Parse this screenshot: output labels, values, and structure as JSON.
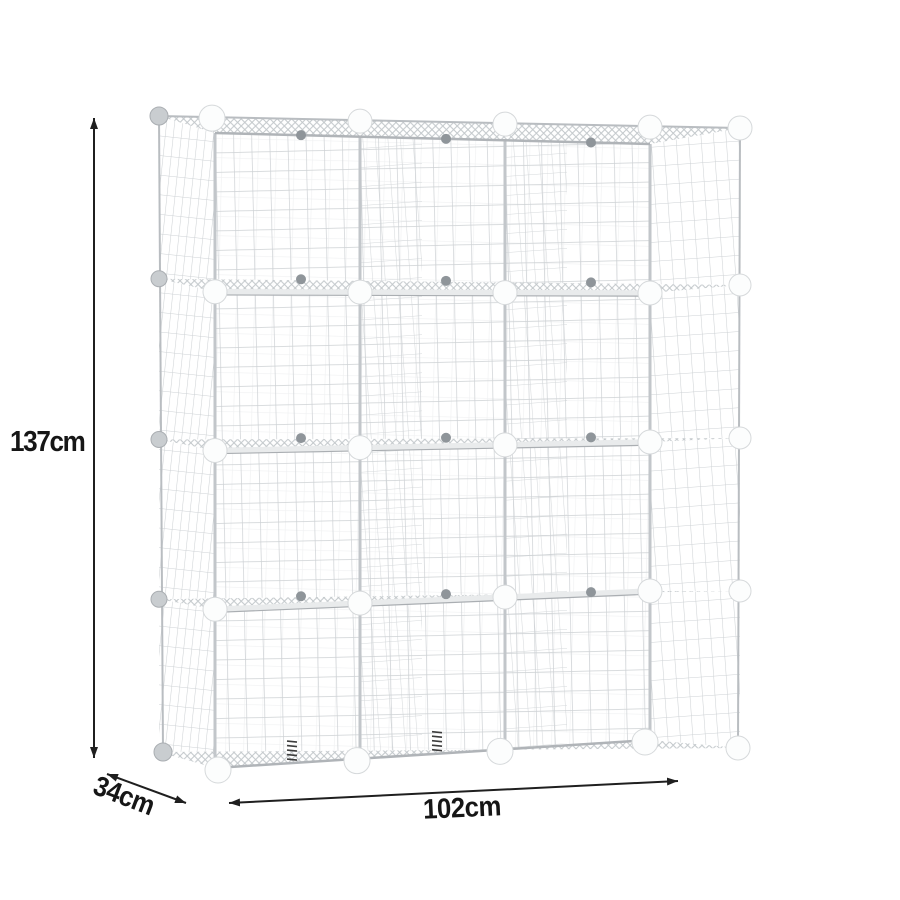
{
  "diagram": {
    "type": "product-dimension-diagram",
    "subject": "white wire grid cube storage organizer shelf",
    "grid": {
      "columns": 3,
      "rows": 4,
      "cubes": 12
    },
    "dimensions": {
      "height": {
        "label": "137cm",
        "value": 137,
        "unit": "cm"
      },
      "width": {
        "label": "102cm",
        "value": 102,
        "unit": "cm"
      },
      "depth": {
        "label": "34cm",
        "value": 34,
        "unit": "cm"
      }
    },
    "colors": {
      "background": "#ffffff",
      "wire": "#cdd1d4",
      "frame": "#b9bdc1",
      "connector_ball": "#fcfdfd",
      "joint_knob": "#8f959a",
      "annotation": "#1a1a1a"
    }
  }
}
